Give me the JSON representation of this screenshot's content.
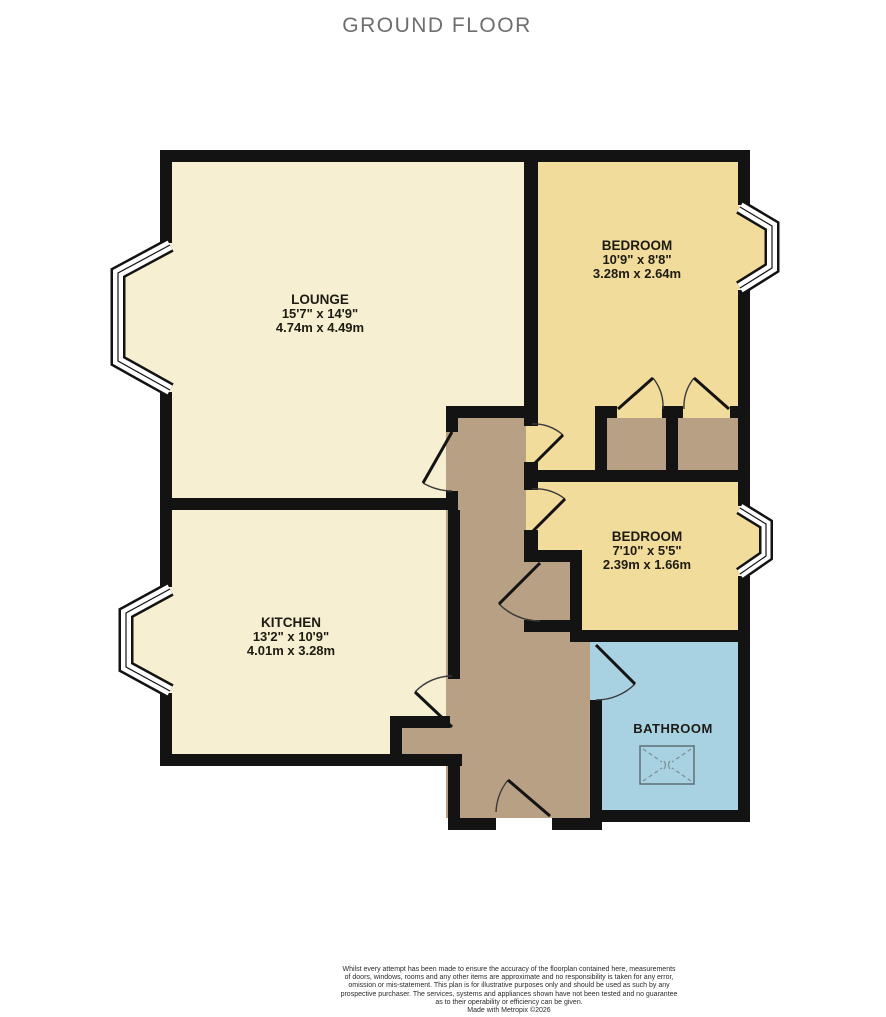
{
  "title": "GROUND FLOOR",
  "plan": {
    "rooms": [
      {
        "key": "lounge",
        "name": "LOUNGE",
        "imperial": "15'7\" x 14'9\"",
        "metric": "4.74m x 4.49m"
      },
      {
        "key": "bedroom-1",
        "name": "BEDROOM",
        "imperial": "10'9\" x 8'8\"",
        "metric": "3.28m x 2.64m"
      },
      {
        "key": "bedroom-2",
        "name": "BEDROOM",
        "imperial": "7'10\" x 5'5\"",
        "metric": "2.39m x 1.66m"
      },
      {
        "key": "kitchen",
        "name": "KITCHEN",
        "imperial": "13'2\" x 10'9\"",
        "metric": "4.01m x 3.28m"
      },
      {
        "key": "bathroom",
        "name": "BATHROOM"
      }
    ],
    "colors": {
      "wall": "#131313",
      "lounge_kitchen": "#f6efd2",
      "bedroom": "#f2dc9b",
      "hallway": "#b7a083",
      "closet": "#b7a083",
      "bathroom": "#a8d2e2",
      "window": "#ffffff"
    }
  },
  "footer": {
    "lines": [
      "Whilst every attempt has been made to ensure the accuracy of the floorplan contained here, measurements",
      "of doors, windows, rooms and any other items are approximate and no responsibility is taken for any error,",
      "omission or mis-statement. This plan is for illustrative purposes only and should be used as such by any",
      "prospective purchaser. The services, systems and appliances shown have not been tested and no guarantee",
      "as to their operability or efficiency can be given.",
      "Made with Metropix ©2026"
    ]
  }
}
